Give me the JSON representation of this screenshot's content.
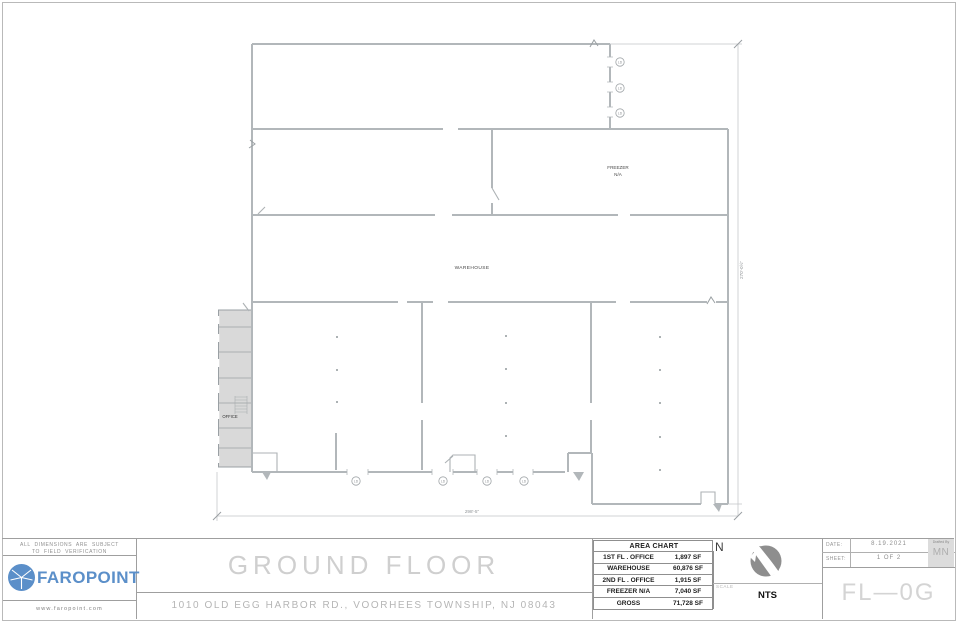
{
  "plan": {
    "labels": {
      "freezer_line1": "FREEZER",
      "freezer_line2": "N/A",
      "warehouse": "WAREHOUSE",
      "office": "OFFICE"
    },
    "dock_label": "LD",
    "dimensions": {
      "bottom": "298'-5\"",
      "right": "270'-0½\""
    }
  },
  "title_block": {
    "disclaimer_line1": "ALL DIMENSIONS ARE SUBJECT",
    "disclaimer_line2": "TO FIELD VERIFICATION",
    "logo_text": "FAROPOINT",
    "website": "www.faropoint.com",
    "title": "GROUND FLOOR",
    "address": "1010 OLD EGG HARBOR RD., VOORHEES TOWNSHIP, NJ 08043",
    "area_chart": {
      "header": "AREA CHART",
      "rows": [
        {
          "label": "1ST FL . OFFICE",
          "value": "1,897 SF"
        },
        {
          "label": "WAREHOUSE",
          "value": "60,876 SF"
        },
        {
          "label": "2ND FL . OFFICE",
          "value": "1,915 SF"
        },
        {
          "label": "FREEZER N/A",
          "value": "7,040 SF"
        },
        {
          "label": "GROSS",
          "value": "71,728 SF"
        }
      ]
    },
    "north_label": "N",
    "scale_label": "SCALE",
    "scale_value": "NTS",
    "date_label": "DATE:",
    "date_value": "8.19.2021",
    "sheet_label": "SHEET:",
    "sheet_value": "1 OF 2",
    "drafted_label": "Drafted By",
    "drafted_value": "MN",
    "sheet_code": "FL—0G"
  },
  "colors": {
    "brand_blue": "#5b8fc9",
    "wall_gray": "#b2b7ba",
    "office_fill": "#d9d9d9",
    "compass_gray": "#8e8e8e"
  }
}
